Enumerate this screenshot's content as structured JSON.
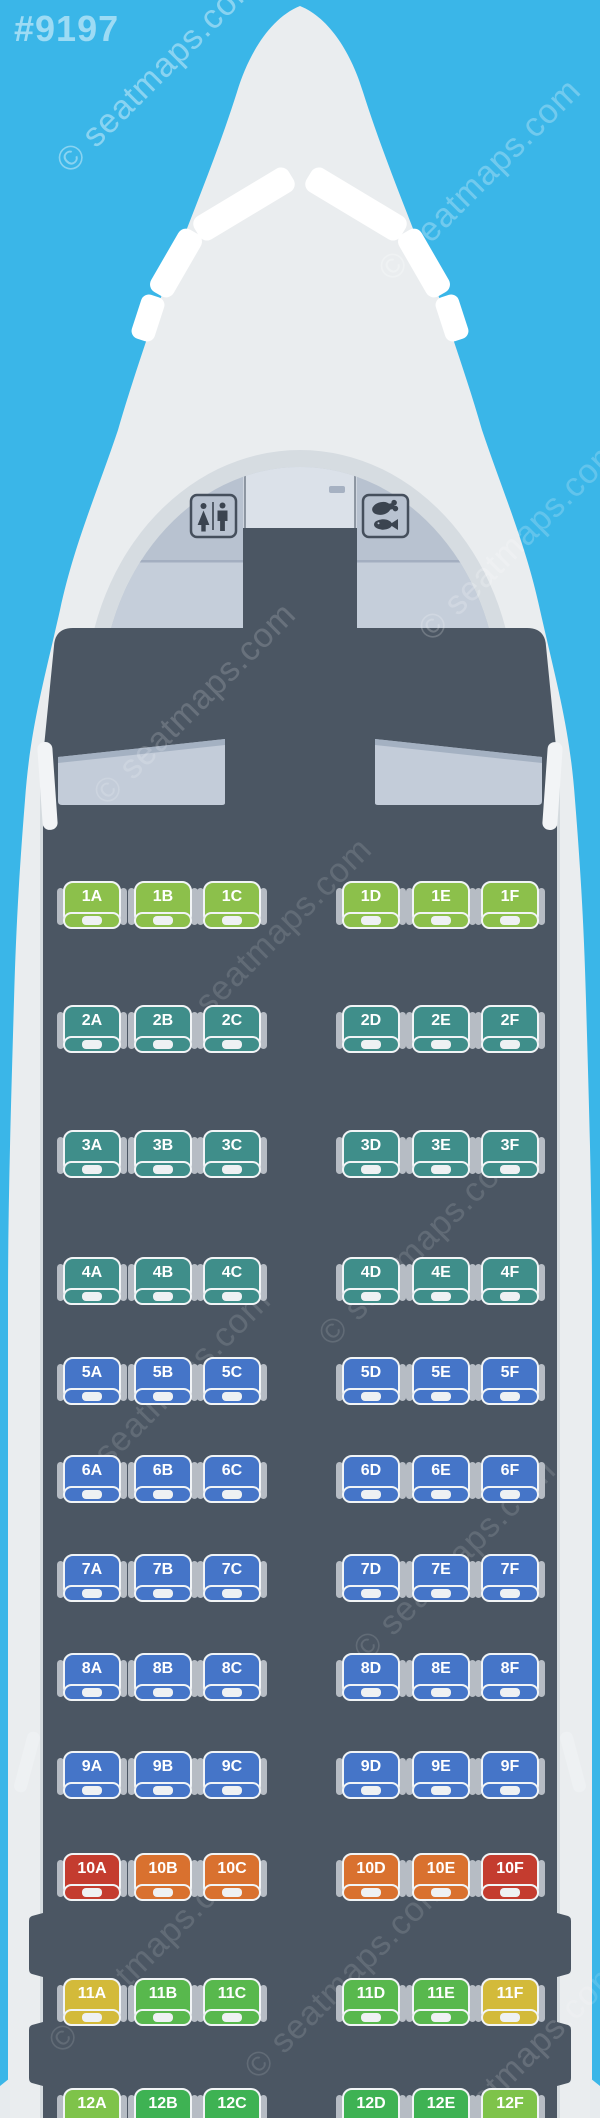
{
  "watermark": {
    "tag": "#9197",
    "site": "© seatmaps.com"
  },
  "palette": {
    "lime": "#8cc04b",
    "teal": "#3f8e8a",
    "blue": "#4575c8",
    "red": "#c43c2f",
    "orange": "#d9712f",
    "yellow": "#d3ba3a",
    "green": "#58b84d",
    "dgreen": "#3eb253",
    "ygreen": "#7ec34a"
  },
  "aircraft": {
    "monuments": [
      {
        "name": "lavatory"
      },
      {
        "name": "galley"
      }
    ]
  },
  "cabin": {
    "rows": [
      {
        "row": "1",
        "seats": [
          {
            "id": "1A",
            "color": "lime"
          },
          {
            "id": "1B",
            "color": "lime"
          },
          {
            "id": "1C",
            "color": "lime"
          },
          {
            "id": "1D",
            "color": "lime"
          },
          {
            "id": "1E",
            "color": "lime"
          },
          {
            "id": "1F",
            "color": "lime"
          }
        ]
      },
      {
        "row": "2",
        "seats": [
          {
            "id": "2A",
            "color": "teal"
          },
          {
            "id": "2B",
            "color": "teal"
          },
          {
            "id": "2C",
            "color": "teal"
          },
          {
            "id": "2D",
            "color": "teal"
          },
          {
            "id": "2E",
            "color": "teal"
          },
          {
            "id": "2F",
            "color": "teal"
          }
        ]
      },
      {
        "row": "3",
        "seats": [
          {
            "id": "3A",
            "color": "teal"
          },
          {
            "id": "3B",
            "color": "teal"
          },
          {
            "id": "3C",
            "color": "teal"
          },
          {
            "id": "3D",
            "color": "teal"
          },
          {
            "id": "3E",
            "color": "teal"
          },
          {
            "id": "3F",
            "color": "teal"
          }
        ]
      },
      {
        "row": "4",
        "seats": [
          {
            "id": "4A",
            "color": "teal"
          },
          {
            "id": "4B",
            "color": "teal"
          },
          {
            "id": "4C",
            "color": "teal"
          },
          {
            "id": "4D",
            "color": "teal"
          },
          {
            "id": "4E",
            "color": "teal"
          },
          {
            "id": "4F",
            "color": "teal"
          }
        ]
      },
      {
        "row": "5",
        "seats": [
          {
            "id": "5A",
            "color": "blue"
          },
          {
            "id": "5B",
            "color": "blue"
          },
          {
            "id": "5C",
            "color": "blue"
          },
          {
            "id": "5D",
            "color": "blue"
          },
          {
            "id": "5E",
            "color": "blue"
          },
          {
            "id": "5F",
            "color": "blue"
          }
        ]
      },
      {
        "row": "6",
        "seats": [
          {
            "id": "6A",
            "color": "blue"
          },
          {
            "id": "6B",
            "color": "blue"
          },
          {
            "id": "6C",
            "color": "blue"
          },
          {
            "id": "6D",
            "color": "blue"
          },
          {
            "id": "6E",
            "color": "blue"
          },
          {
            "id": "6F",
            "color": "blue"
          }
        ]
      },
      {
        "row": "7",
        "seats": [
          {
            "id": "7A",
            "color": "blue"
          },
          {
            "id": "7B",
            "color": "blue"
          },
          {
            "id": "7C",
            "color": "blue"
          },
          {
            "id": "7D",
            "color": "blue"
          },
          {
            "id": "7E",
            "color": "blue"
          },
          {
            "id": "7F",
            "color": "blue"
          }
        ]
      },
      {
        "row": "8",
        "seats": [
          {
            "id": "8A",
            "color": "blue"
          },
          {
            "id": "8B",
            "color": "blue"
          },
          {
            "id": "8C",
            "color": "blue"
          },
          {
            "id": "8D",
            "color": "blue"
          },
          {
            "id": "8E",
            "color": "blue"
          },
          {
            "id": "8F",
            "color": "blue"
          }
        ]
      },
      {
        "row": "9",
        "seats": [
          {
            "id": "9A",
            "color": "blue"
          },
          {
            "id": "9B",
            "color": "blue"
          },
          {
            "id": "9C",
            "color": "blue"
          },
          {
            "id": "9D",
            "color": "blue"
          },
          {
            "id": "9E",
            "color": "blue"
          },
          {
            "id": "9F",
            "color": "blue"
          }
        ]
      },
      {
        "row": "10",
        "seats": [
          {
            "id": "10A",
            "color": "red"
          },
          {
            "id": "10B",
            "color": "orange"
          },
          {
            "id": "10C",
            "color": "orange"
          },
          {
            "id": "10D",
            "color": "orange"
          },
          {
            "id": "10E",
            "color": "orange"
          },
          {
            "id": "10F",
            "color": "red"
          }
        ]
      },
      {
        "row": "11",
        "seats": [
          {
            "id": "11A",
            "color": "yellow"
          },
          {
            "id": "11B",
            "color": "green"
          },
          {
            "id": "11C",
            "color": "green"
          },
          {
            "id": "11D",
            "color": "green"
          },
          {
            "id": "11E",
            "color": "green"
          },
          {
            "id": "11F",
            "color": "yellow"
          }
        ]
      },
      {
        "row": "12",
        "seats": [
          {
            "id": "12A",
            "color": "ygreen"
          },
          {
            "id": "12B",
            "color": "dgreen"
          },
          {
            "id": "12C",
            "color": "dgreen"
          },
          {
            "id": "12D",
            "color": "dgreen"
          },
          {
            "id": "12E",
            "color": "dgreen"
          },
          {
            "id": "12F",
            "color": "ygreen"
          }
        ]
      }
    ]
  }
}
